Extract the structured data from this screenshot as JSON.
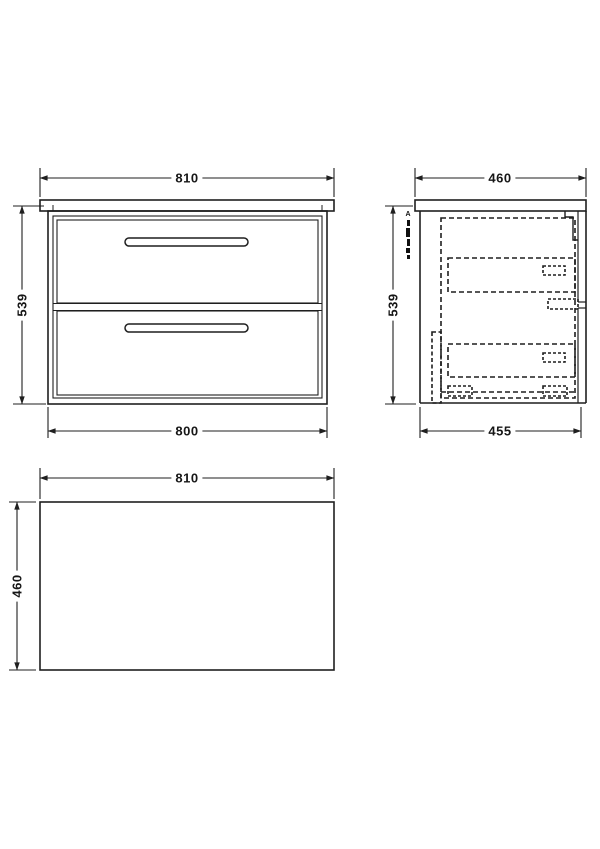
{
  "drawing_type": "vanity-unit-dimension-drawing",
  "colors": {
    "line": "#1f1f1f",
    "background": "#ffffff"
  },
  "views": {
    "front": {
      "width_top": "810",
      "height_left": "539",
      "width_bottom": "800"
    },
    "side": {
      "depth_top": "460",
      "height_left": "539",
      "depth_bottom": "455",
      "tiny_label": "A"
    },
    "plan": {
      "width_top": "810",
      "depth_left": "460"
    }
  }
}
